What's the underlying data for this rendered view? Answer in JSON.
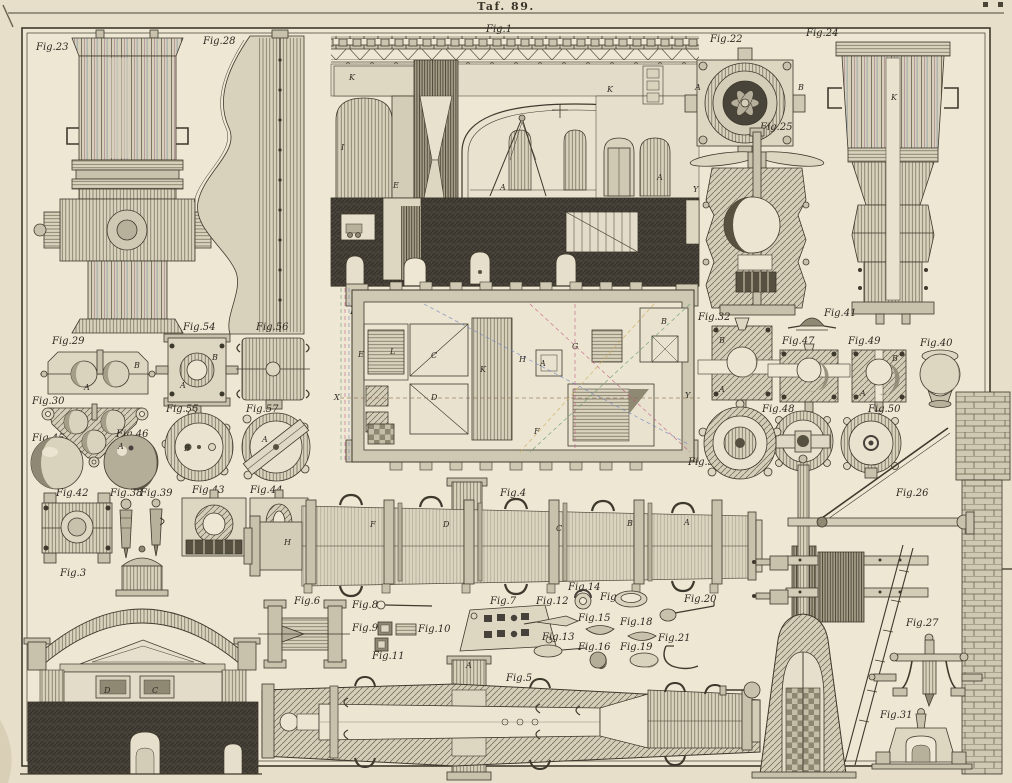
{
  "plate": {
    "title": "Taf. 89."
  },
  "figures": {
    "fig1": {
      "label": "Fig.1"
    },
    "fig2": {
      "label": "Fig.2"
    },
    "fig3": {
      "label": "Fig.3"
    },
    "fig4": {
      "label": "Fig.4"
    },
    "fig5": {
      "label": "Fig.5"
    },
    "fig6": {
      "label": "Fig.6"
    },
    "fig7": {
      "label": "Fig.7"
    },
    "fig8": {
      "label": "Fig.8"
    },
    "fig9": {
      "label": "Fig.9"
    },
    "fig10": {
      "label": "Fig.10"
    },
    "fig11": {
      "label": "Fig.11"
    },
    "fig12": {
      "label": "Fig.12"
    },
    "fig13": {
      "label": "Fig.13"
    },
    "fig14": {
      "label": "Fig.14"
    },
    "fig15": {
      "label": "Fig.15"
    },
    "fig16": {
      "label": "Fig.16"
    },
    "fig17": {
      "label": "Fig.17"
    },
    "fig18": {
      "label": "Fig.18"
    },
    "fig19": {
      "label": "Fig.19"
    },
    "fig20": {
      "label": "Fig.20"
    },
    "fig21": {
      "label": "Fig.21"
    },
    "fig22": {
      "label": "Fig.22"
    },
    "fig23": {
      "label": "Fig.23"
    },
    "fig24": {
      "label": "Fig.24"
    },
    "fig25": {
      "label": "Fig.25"
    },
    "fig26": {
      "label": "Fig.26"
    },
    "fig27": {
      "label": "Fig.27"
    },
    "fig28": {
      "label": "Fig.28"
    },
    "fig29": {
      "label": "Fig.29"
    },
    "fig30": {
      "label": "Fig.30"
    },
    "fig31": {
      "label": "Fig.31"
    },
    "fig32": {
      "label": "Fig.32"
    },
    "fig38": {
      "label": "Fig.38"
    },
    "fig39": {
      "label": "Fig.39"
    },
    "fig40": {
      "label": "Fig.40"
    },
    "fig41": {
      "label": "Fig.41"
    },
    "fig42": {
      "label": "Fig.42"
    },
    "fig43": {
      "label": "Fig.43"
    },
    "fig44": {
      "label": "Fig.44"
    },
    "fig45": {
      "label": "Fig.45"
    },
    "fig46": {
      "label": "Fig.46"
    },
    "fig47": {
      "label": "Fig.47"
    },
    "fig48": {
      "label": "Fig.48"
    },
    "fig49": {
      "label": "Fig.49"
    },
    "fig50": {
      "label": "Fig.50"
    },
    "fig53": {
      "label": "Fig.53"
    },
    "fig54": {
      "label": "Fig.54"
    },
    "fig55": {
      "label": "Fig.55"
    },
    "fig56": {
      "label": "Fig.56"
    },
    "fig57": {
      "label": "Fig.57"
    }
  },
  "letters": [
    {
      "t": "K",
      "x": 349,
      "y": 80
    },
    {
      "t": "I",
      "x": 341,
      "y": 150
    },
    {
      "t": "E",
      "x": 393,
      "y": 188
    },
    {
      "t": "A",
      "x": 500,
      "y": 190
    },
    {
      "t": "K",
      "x": 607,
      "y": 92
    },
    {
      "t": "A",
      "x": 657,
      "y": 180
    },
    {
      "t": "Y",
      "x": 693,
      "y": 192
    },
    {
      "t": "E",
      "x": 358,
      "y": 357
    },
    {
      "t": "L",
      "x": 390,
      "y": 354
    },
    {
      "t": "C",
      "x": 431,
      "y": 358
    },
    {
      "t": "K",
      "x": 480,
      "y": 372
    },
    {
      "t": "H",
      "x": 519,
      "y": 362
    },
    {
      "t": "A",
      "x": 540,
      "y": 366
    },
    {
      "t": "G",
      "x": 572,
      "y": 349
    },
    {
      "t": "B",
      "x": 661,
      "y": 324
    },
    {
      "t": "D",
      "x": 431,
      "y": 400
    },
    {
      "t": "F",
      "x": 534,
      "y": 434
    },
    {
      "t": "X",
      "x": 334,
      "y": 400
    },
    {
      "t": "Y",
      "x": 685,
      "y": 398
    },
    {
      "t": "H",
      "x": 284,
      "y": 545
    },
    {
      "t": "F",
      "x": 370,
      "y": 527
    },
    {
      "t": "D",
      "x": 443,
      "y": 527
    },
    {
      "t": "C",
      "x": 556,
      "y": 531
    },
    {
      "t": "B",
      "x": 627,
      "y": 526
    },
    {
      "t": "A",
      "x": 684,
      "y": 525
    },
    {
      "t": "A",
      "x": 466,
      "y": 668
    },
    {
      "t": "B",
      "x": 134,
      "y": 368
    },
    {
      "t": "A",
      "x": 84,
      "y": 390
    },
    {
      "t": "A",
      "x": 118,
      "y": 449
    },
    {
      "t": "K",
      "x": 891,
      "y": 100
    },
    {
      "t": "A",
      "x": 695,
      "y": 90
    },
    {
      "t": "B",
      "x": 798,
      "y": 90
    },
    {
      "t": "B",
      "x": 719,
      "y": 343
    },
    {
      "t": "A",
      "x": 719,
      "y": 392
    },
    {
      "t": "B",
      "x": 892,
      "y": 361
    },
    {
      "t": "A",
      "x": 860,
      "y": 396
    },
    {
      "t": "D",
      "x": 104,
      "y": 693
    },
    {
      "t": "C",
      "x": 152,
      "y": 693
    },
    {
      "t": "B",
      "x": 184,
      "y": 451
    },
    {
      "t": "A",
      "x": 262,
      "y": 442
    },
    {
      "t": "A",
      "x": 180,
      "y": 388
    },
    {
      "t": "B",
      "x": 212,
      "y": 360
    }
  ]
}
